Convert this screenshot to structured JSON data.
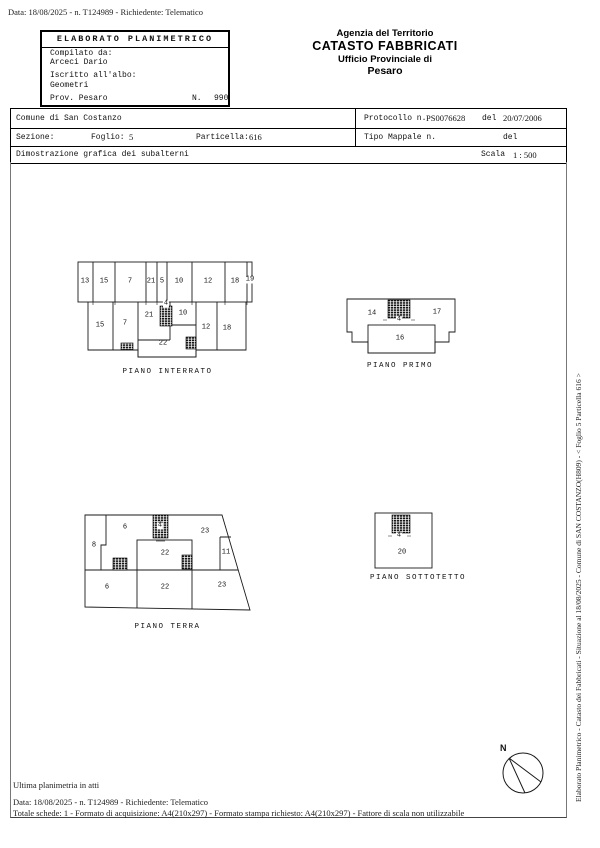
{
  "header": {
    "top_margin_line": "Data: 18/08/2025 - n. T124989 - Richiedente: Telematico",
    "elaborato_box": {
      "title": "ELABORATO PLANIMETRICO",
      "compilato_label": "Compilato da:",
      "compilato_value": "Arceci Dario",
      "iscritto_label": "Iscritto all'albo:",
      "iscritto_value": "Geometri",
      "prov_label": "Prov. Pesaro",
      "n_label": "N.",
      "n_value": "990"
    },
    "agency": {
      "line1": "Agenzia del Territorio",
      "line2": "CATASTO FABBRICATI",
      "line3": "Ufficio Provinciale di",
      "line4": "Pesaro"
    }
  },
  "info_table": {
    "comune": "Comune di San Costanzo",
    "protocollo_label": "Protocollo n.",
    "protocollo_value": "PS0076628",
    "protocollo_del_label": "del",
    "protocollo_del_value": "20/07/2006",
    "sezione_label": "Sezione:",
    "foglio_label": "Foglio:",
    "foglio_value": "5",
    "particella_label": "Particella:",
    "particella_value": "616",
    "tipo_mappale_label": "Tipo Mappale n.",
    "tipo_mappale_del_label": "del",
    "dimostrazione": "Dimostrazione grafica dei subalterni",
    "scala_label": "Scala",
    "scala_value": "1 : 500"
  },
  "plans": [
    {
      "caption": "PIANO INTERRATO",
      "labels": [
        "13",
        "15",
        "7",
        "21",
        "5",
        "10",
        "12",
        "18",
        "19",
        "15",
        "7",
        "21",
        "4",
        "10",
        "22",
        "12",
        "18"
      ]
    },
    {
      "caption": "PIANO PRIMO",
      "labels": [
        "14",
        "4",
        "17",
        "16"
      ]
    },
    {
      "caption": "PIANO TERRA",
      "labels": [
        "6",
        "8",
        "4",
        "23",
        "11",
        "22",
        "6",
        "22",
        "23"
      ]
    },
    {
      "caption": "PIANO SOTTOTETTO",
      "labels": [
        "4",
        "20"
      ]
    }
  ],
  "compass": {
    "north_label": "N"
  },
  "footer": {
    "ultima_line": "Ultima planimetria in atti",
    "data_line": "Data: 18/08/2025 - n. T124989 - Richiedente: Telematico",
    "totale_line": "Totale schede: 1 - Formato di acquisizione: A4(210x297)  - Formato stampa richiesto: A4(210x297) - Fattore di scala non utilizzabile"
  },
  "sidebar_vertical_text": "Elaborato Planimetrico - Catasto dei Fabbricati - Situazione al 18/08/2025 - Comune di SAN COSTANZO(H809) - < Foglio 5 Particella 616 >"
}
